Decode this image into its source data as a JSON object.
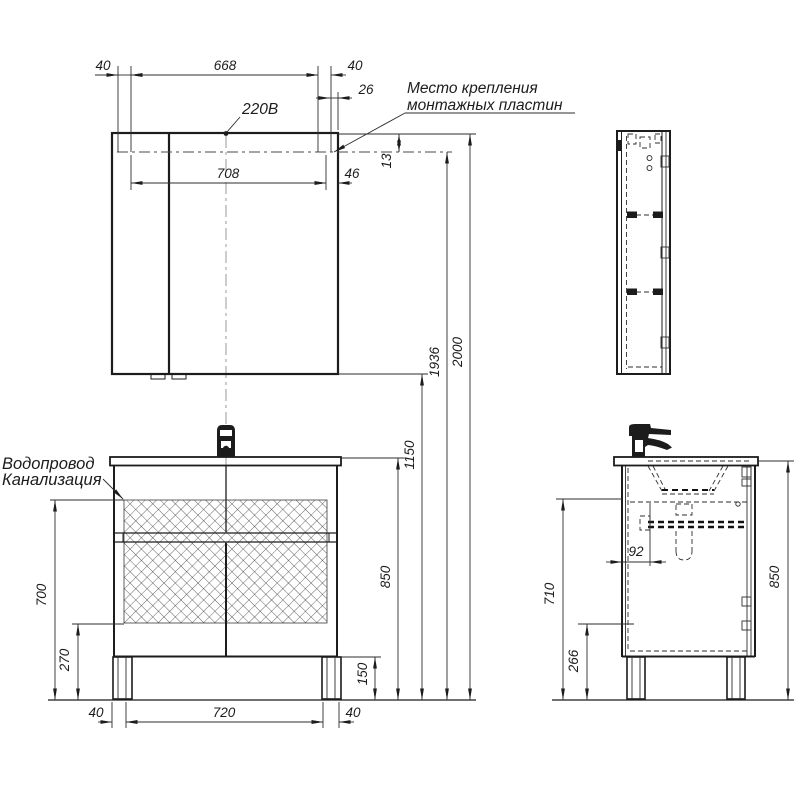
{
  "colors": {
    "line": "#1c1c1c",
    "thin": "#2e2e2e",
    "center": "#9a9a9a",
    "bg": "#ffffff"
  },
  "labels": {
    "mounting_line1": "Место крепления",
    "mounting_line2": "монтажных пластин",
    "power": "220В",
    "water": "Водопровод",
    "sewer": "Канализация"
  },
  "dims": {
    "mirror": {
      "left40": "40",
      "span668": "668",
      "right40": "40",
      "inset26": "26",
      "span708": "708",
      "gap46": "46",
      "drop13": "13"
    },
    "heights": {
      "total": "2000",
      "mounting": "1936",
      "mirror_bottom": "1150",
      "countertop": "850",
      "legs": "150"
    },
    "vanity": {
      "zone_top": "700",
      "zone_bottom": "270",
      "bottom_left40": "40",
      "bottom_span720": "720",
      "bottom_right40": "40"
    },
    "side": {
      "drain92": "92",
      "height710": "710",
      "clearance266": "266",
      "countertop850": "850"
    }
  }
}
